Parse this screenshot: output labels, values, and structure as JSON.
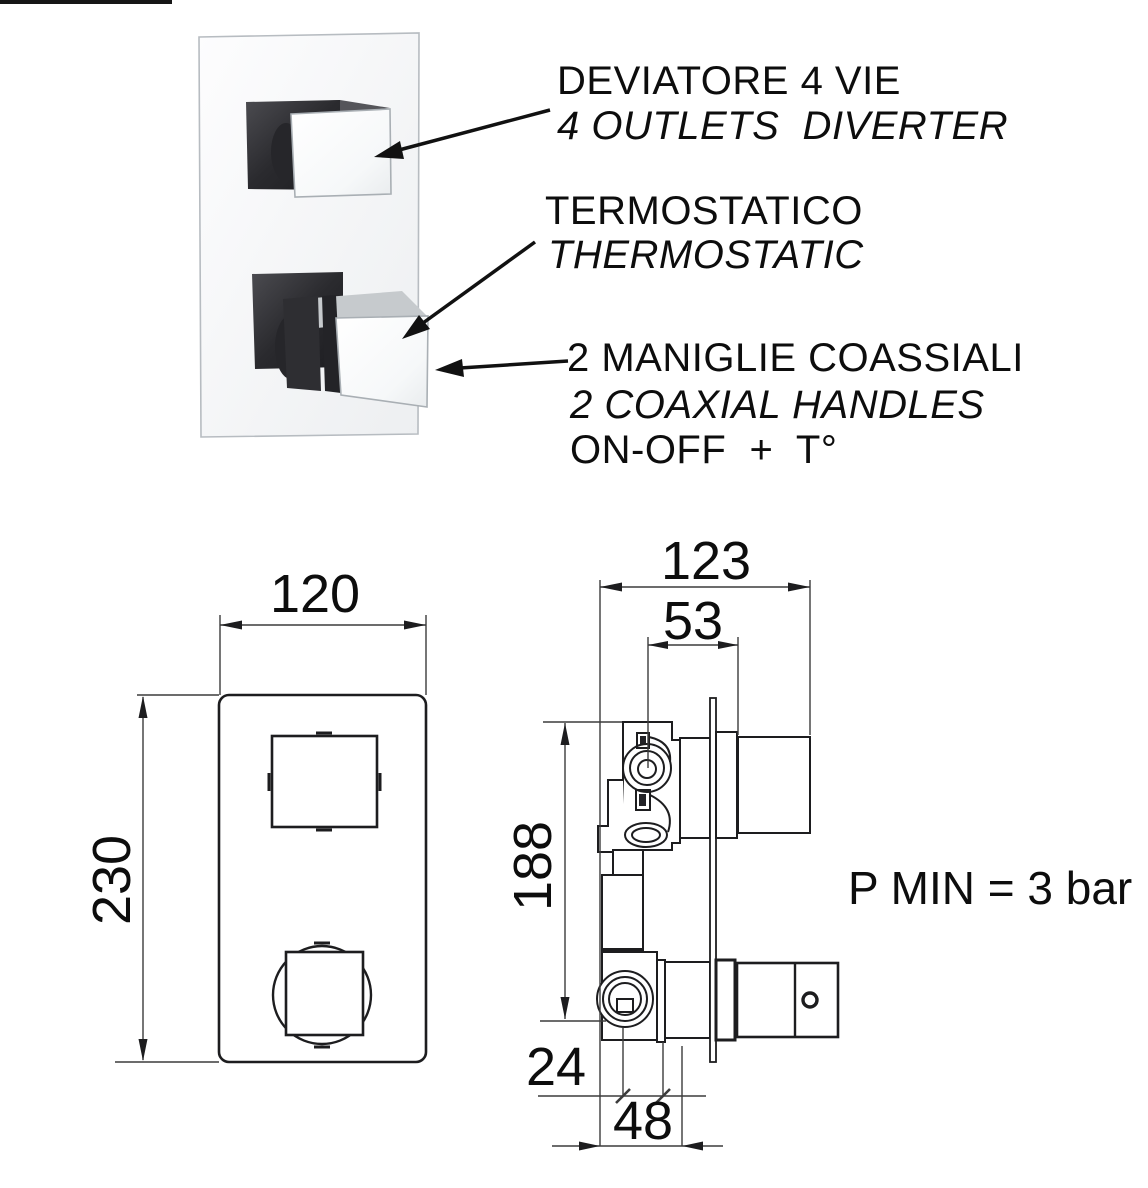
{
  "colors": {
    "ink": "#1d1d1f",
    "dim_line": "#3c3c3c",
    "knob_dark": "#2e2e32",
    "plate_edge": "#b7bcc1",
    "chrome_face": "#fafbfc"
  },
  "callouts": {
    "diverter_it": "DEVIATORE 4 VIE",
    "diverter_en": "4 OUTLETS  DIVERTER",
    "thermo_it": "TERMOSTATICO",
    "thermo_en": "THERMOSTATIC",
    "handles_it": "2 MANIGLIE COASSIALI",
    "handles_en": "2 COAXIAL HANDLES",
    "handles_mode": "ON-OFF  +  T°"
  },
  "front_view": {
    "width": "120",
    "height": "230"
  },
  "side_view": {
    "depth_total": "123",
    "depth_inner": "53",
    "height": "188",
    "offset_a": "24",
    "offset_b": "48"
  },
  "note_pressure": "P MIN = 3 bar"
}
